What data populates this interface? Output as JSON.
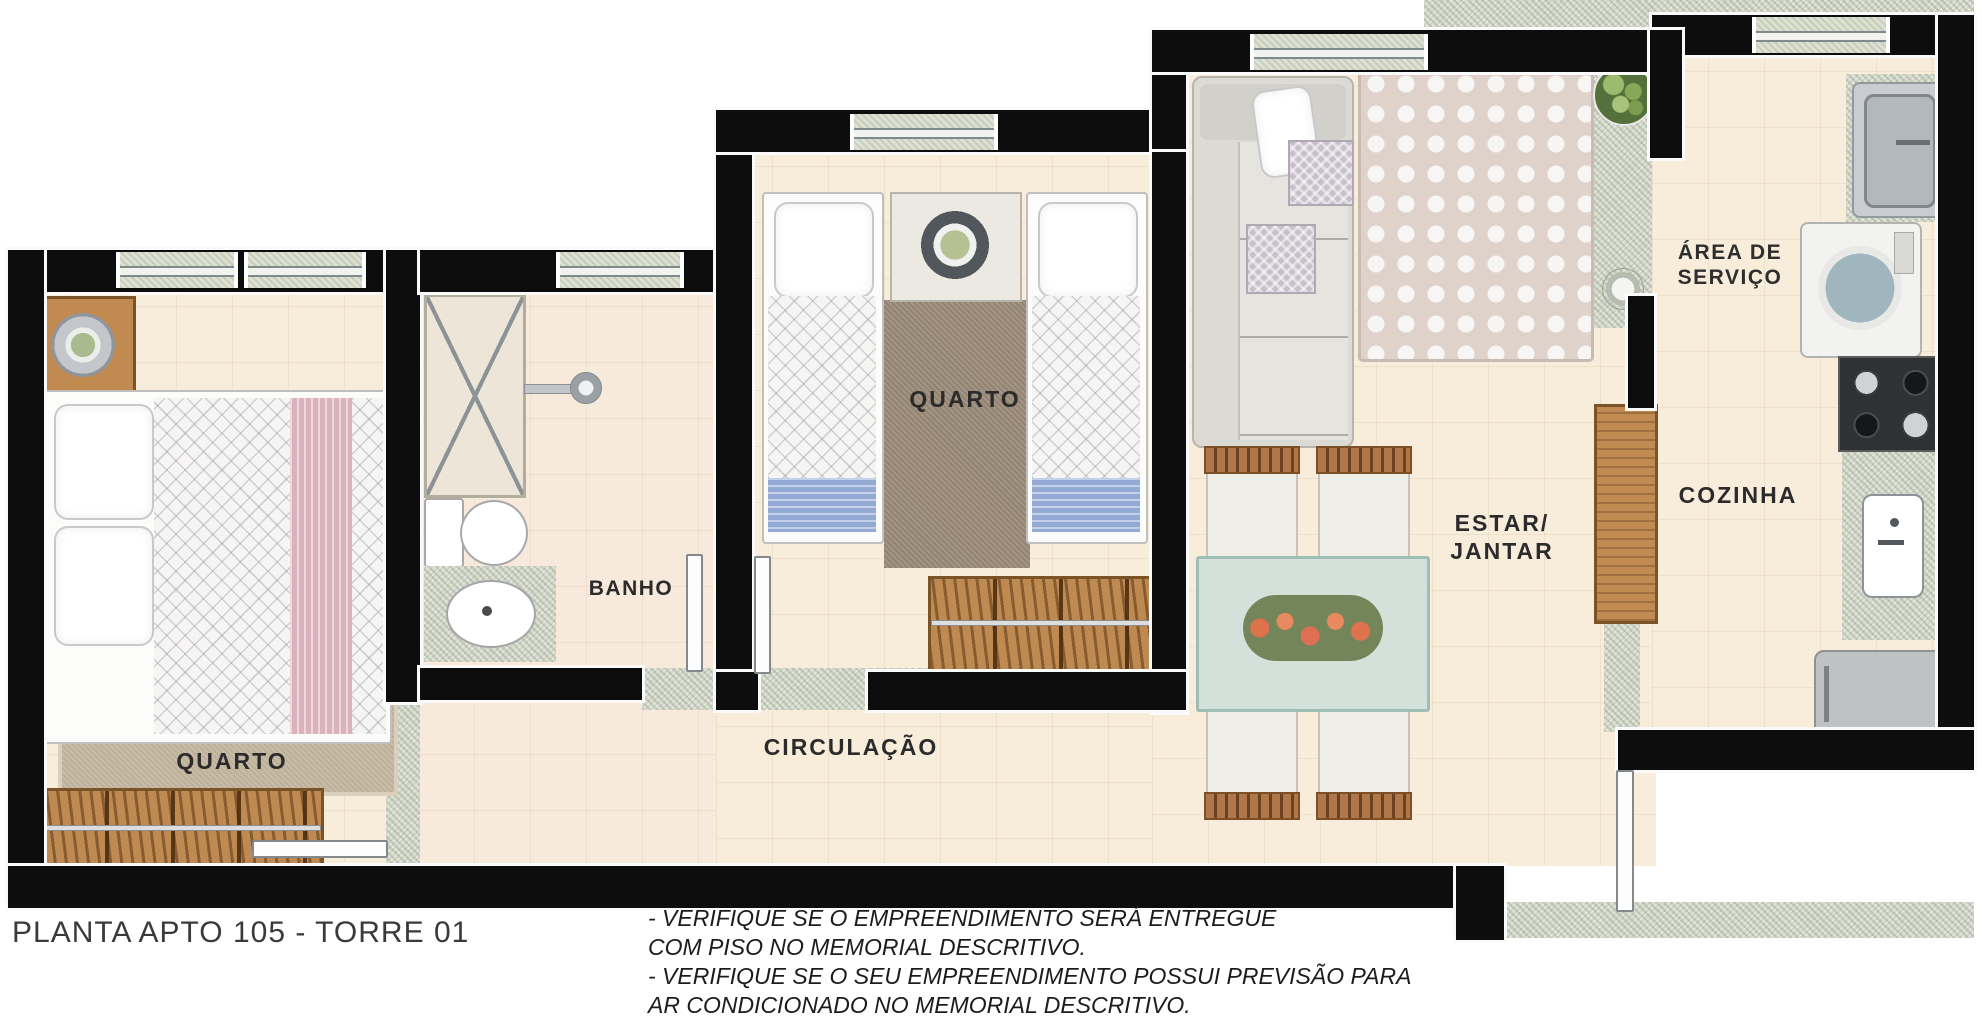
{
  "title": "PLANTA APTO 105 - TORRE 01",
  "rooms": {
    "quarto1": "QUARTO",
    "quarto2": "QUARTO",
    "banho": "BANHO",
    "circulacao": "CIRCULAÇÃO",
    "estar": [
      "ESTAR/",
      "JANTAR"
    ],
    "cozinha": "COZINHA",
    "servico": [
      "ÁREA DE",
      "SERVIÇO"
    ]
  },
  "notes": {
    "lines": [
      "- VERIFIQUE SE O EMPREENDIMENTO SERÁ ENTREGUE",
      "COM PISO NO MEMORIAL DESCRITIVO.",
      "- VERIFIQUE SE O SEU EMPREENDIMENTO POSSUI PREVISÃO PARA",
      "AR CONDICIONADO NO MEMORIAL DESCRITIVO."
    ]
  },
  "icons": {
    "double-bed": "bedroom 1 double bed",
    "single-bed": "bedroom 2 twin beds",
    "wardrobe": "open closet with hangers",
    "shower": "shower box with X",
    "toilet": "toilet",
    "sink": "oval basin",
    "sofa": "gray L sofa",
    "dining-table": "glass table with flowers",
    "stove": "4-burner cooktop",
    "fridge": "refrigerator",
    "washer": "washing machine",
    "laundry-tank": "utility sink",
    "plant": "potted plant"
  },
  "colors": {
    "wall": "#0d0d0d",
    "floor": "#f7edda",
    "granite": "#d3d8c9",
    "blanket_blue": "#92a9d3",
    "runner_pink": "#d9b2bd",
    "wood": "#c08a51"
  }
}
